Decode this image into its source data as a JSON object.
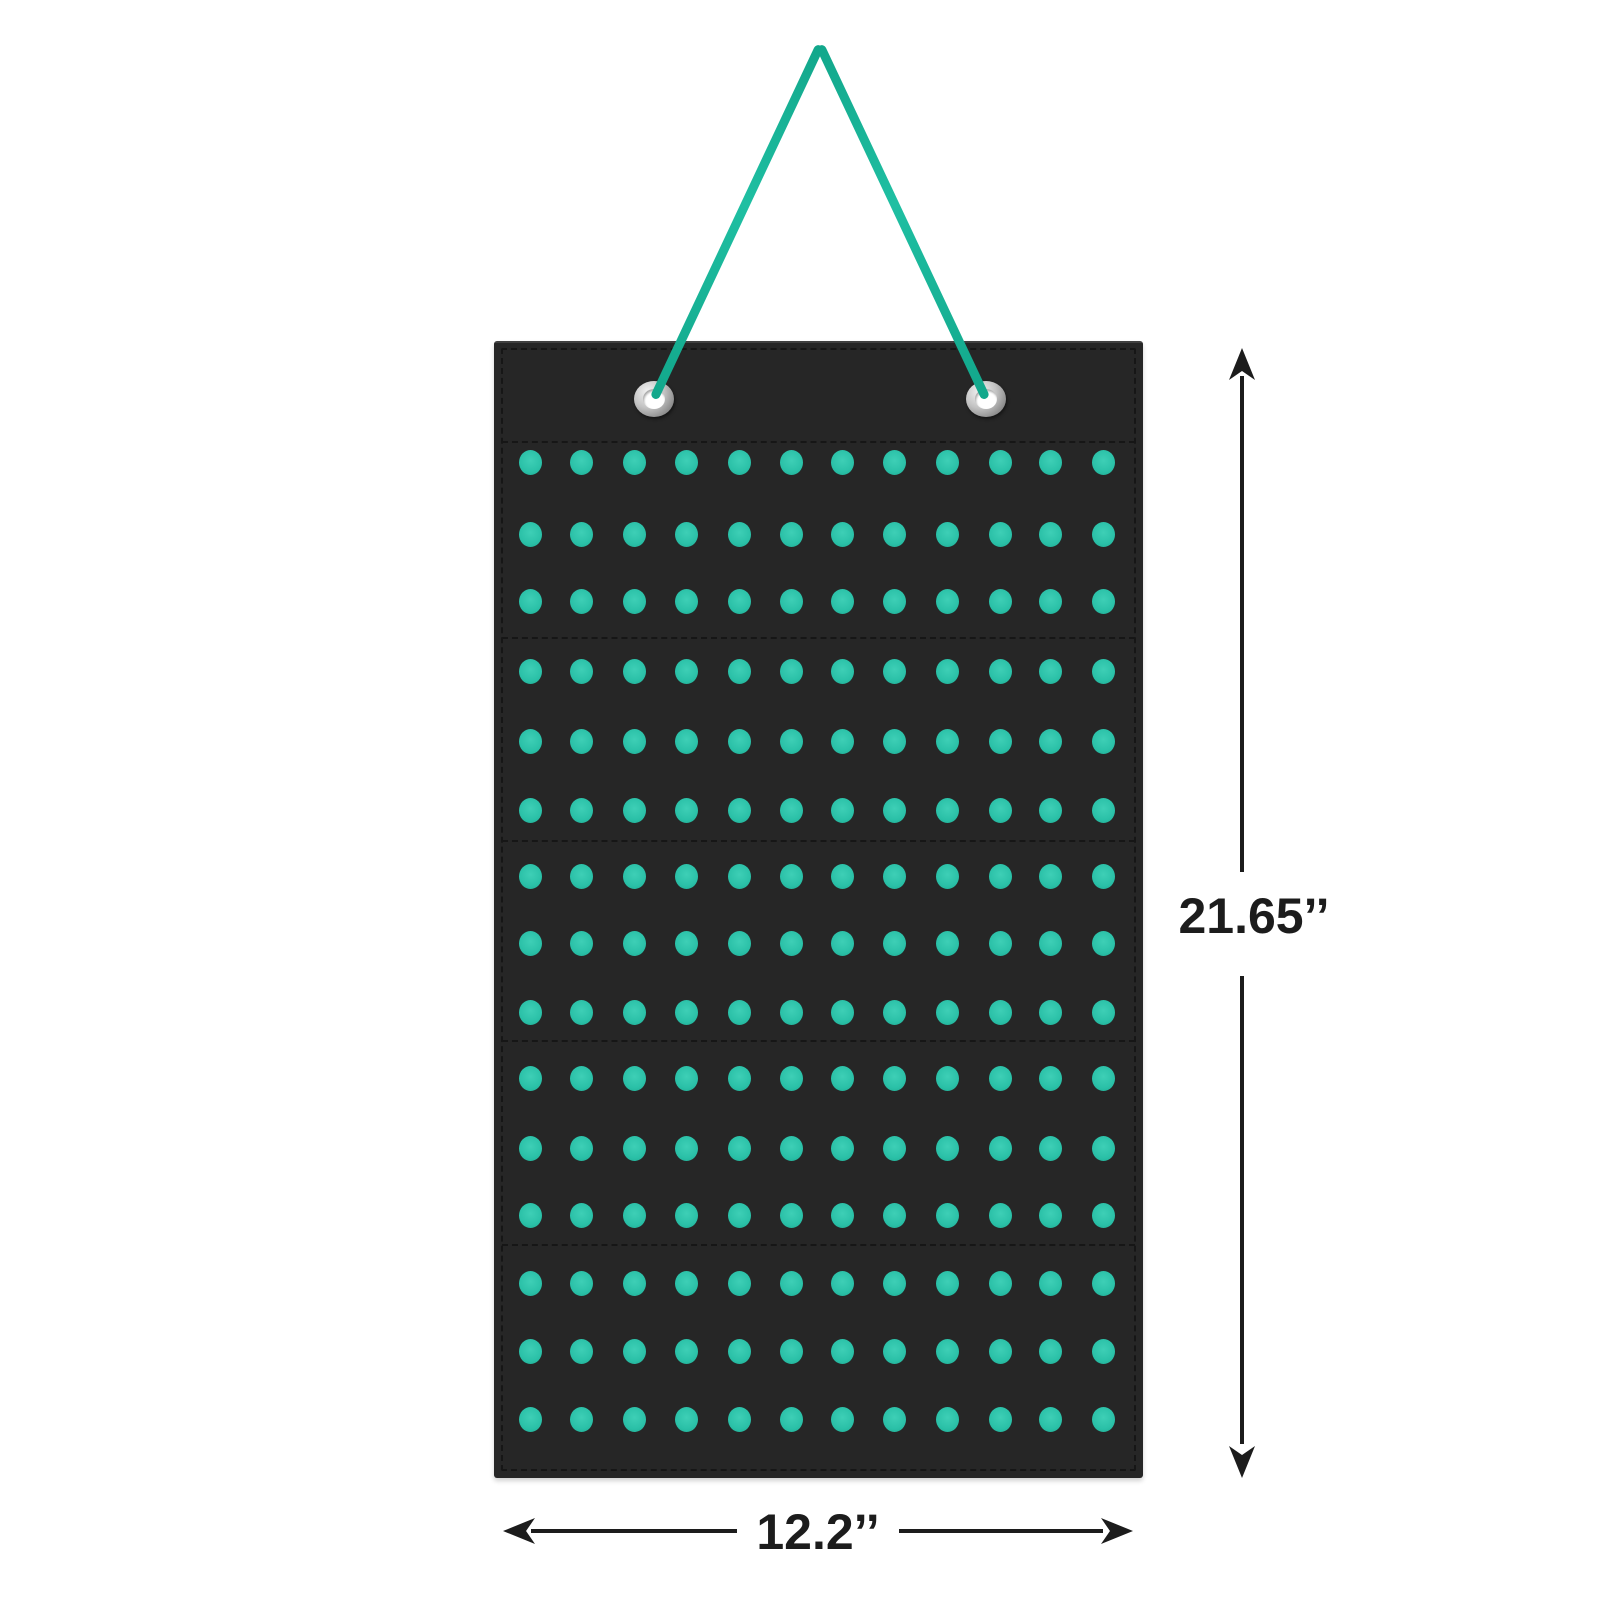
{
  "annotations": {
    "height_label": "21.65’’",
    "width_label": "12.2’’",
    "dimension_color": "#1c1c1c"
  },
  "organizer": {
    "panel_color": "#262626",
    "stitch_color": "#161616",
    "dot_color": "#2ac0a7",
    "dot_highlight_color": "#3ecfb6",
    "cord_color": "#12a78b",
    "cord_highlight_color": "#1fbfa2",
    "grommet_color": "#c2c2c2",
    "grommet_count": 2,
    "grid": {
      "rows": 15,
      "columns": 12,
      "sections": 5
    }
  }
}
